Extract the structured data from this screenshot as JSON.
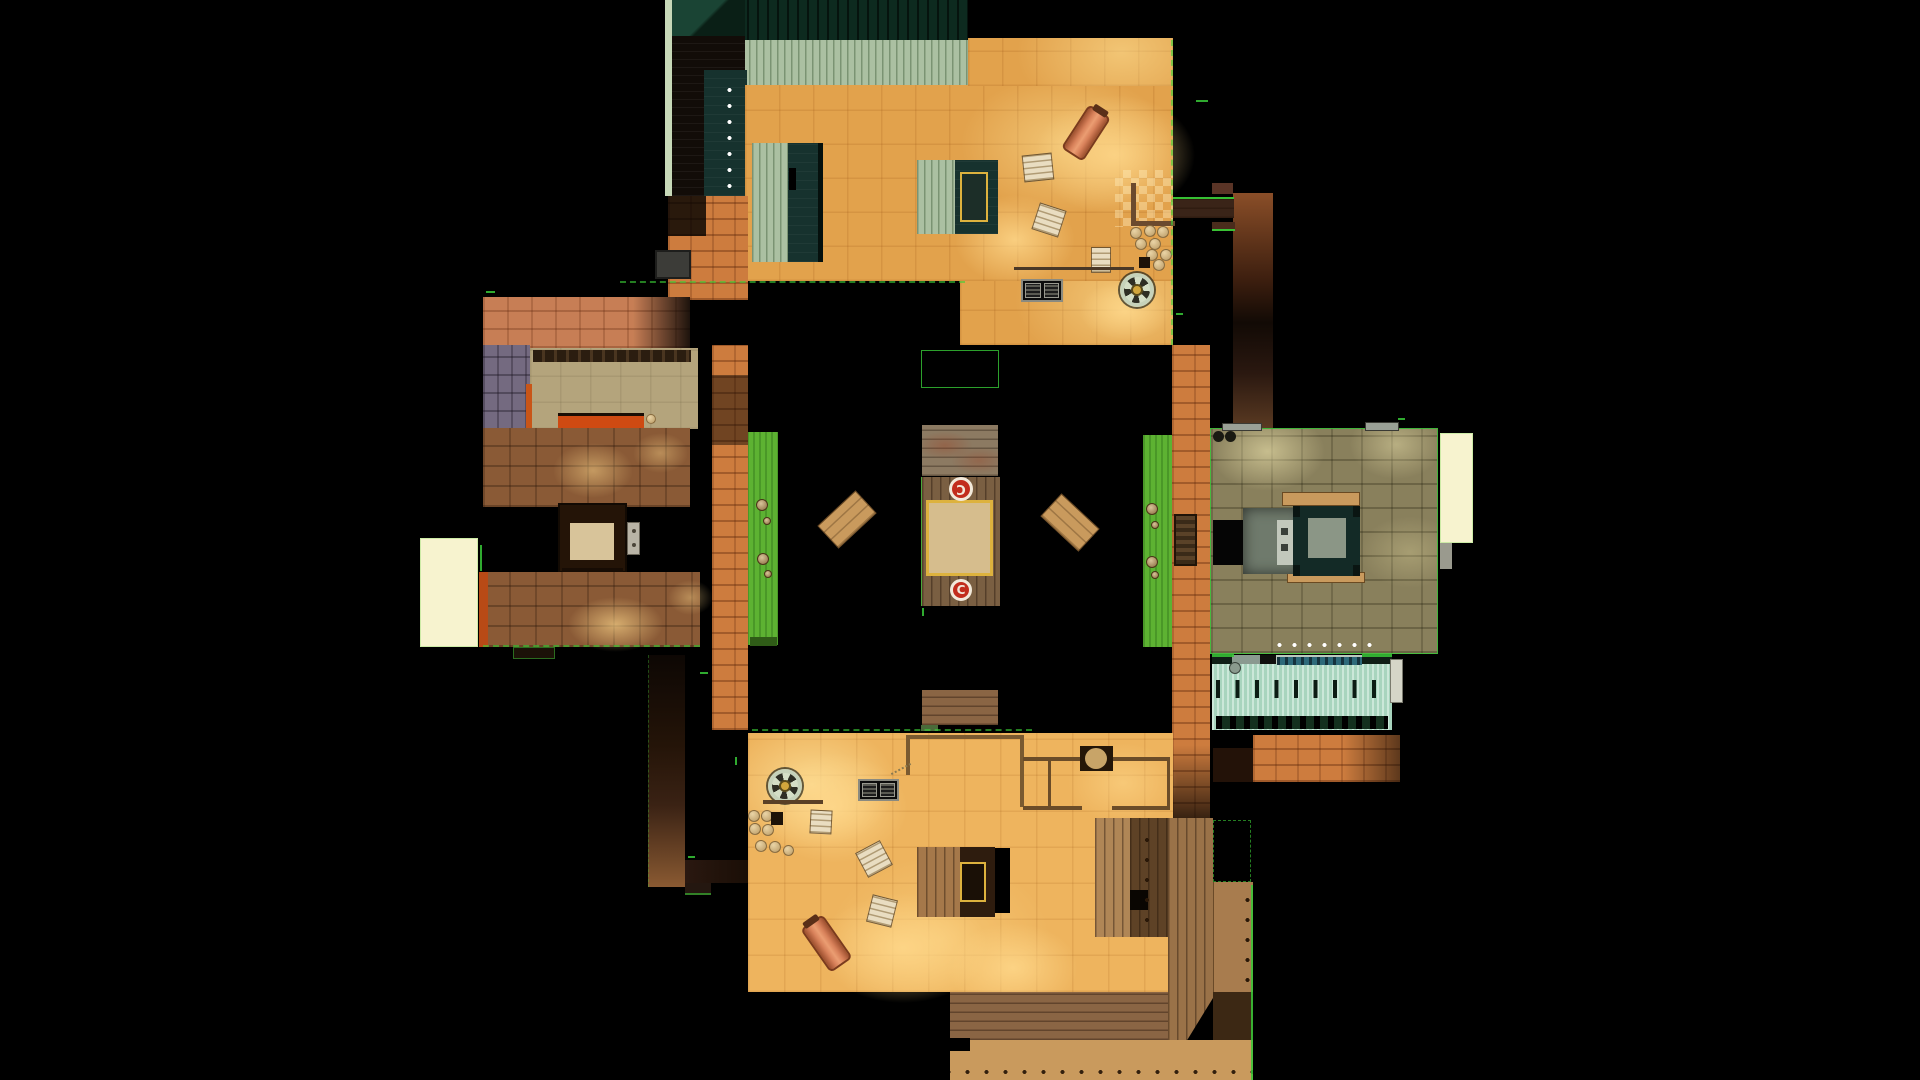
{
  "markers": {
    "top": {
      "label": "C"
    },
    "bottom": {
      "label": "C"
    }
  },
  "colors": {
    "background": "#000000",
    "edge_green": "#37c837",
    "edge_green_pale": "#cdeba6",
    "marker_red": "#c22d1d",
    "marker_ring": "#f2e9da",
    "sand": "#e2a24c",
    "sand_glow": "#ffd98c",
    "sand_bottom": "#eeb45e",
    "orange_brick": "#cd7c3e",
    "orange_brick_shadow": "#53290f",
    "salmon": "#c77e55",
    "cobble": "#8a5a36",
    "beige": "#b4a47c",
    "purple_brick": "#746a80",
    "shelf_dark": "#2b1d10",
    "red_band": "#cf4a12",
    "cream": "#f7f3cf",
    "grass": "#5db232",
    "grass_dark": "#2f5c17",
    "sage": "#abc0a2",
    "roof_dark_green": "#0d2a1f",
    "teal_dark": "#16322e",
    "olive": "#89805c",
    "pool_water": "#b5dec9",
    "pool_band": "#0e2014",
    "pool_teal_bar": "#2e6a7a",
    "wood_bridge": "#7a5f42",
    "wood_gray": "#8c7a62",
    "wood_light": "#c99a5d",
    "wood_deck": "#8a6544",
    "wood_walkway": "#a87c4e",
    "wood_dark": "#3a2418",
    "barrel": "#d8815a",
    "pallet": "#e9ddc1",
    "sand_inlay": "#d6bd8d",
    "yellow_trim": "#ddb23e",
    "machine_gray": "#6f7a6c",
    "metal_gray": "#c2c8bc"
  }
}
